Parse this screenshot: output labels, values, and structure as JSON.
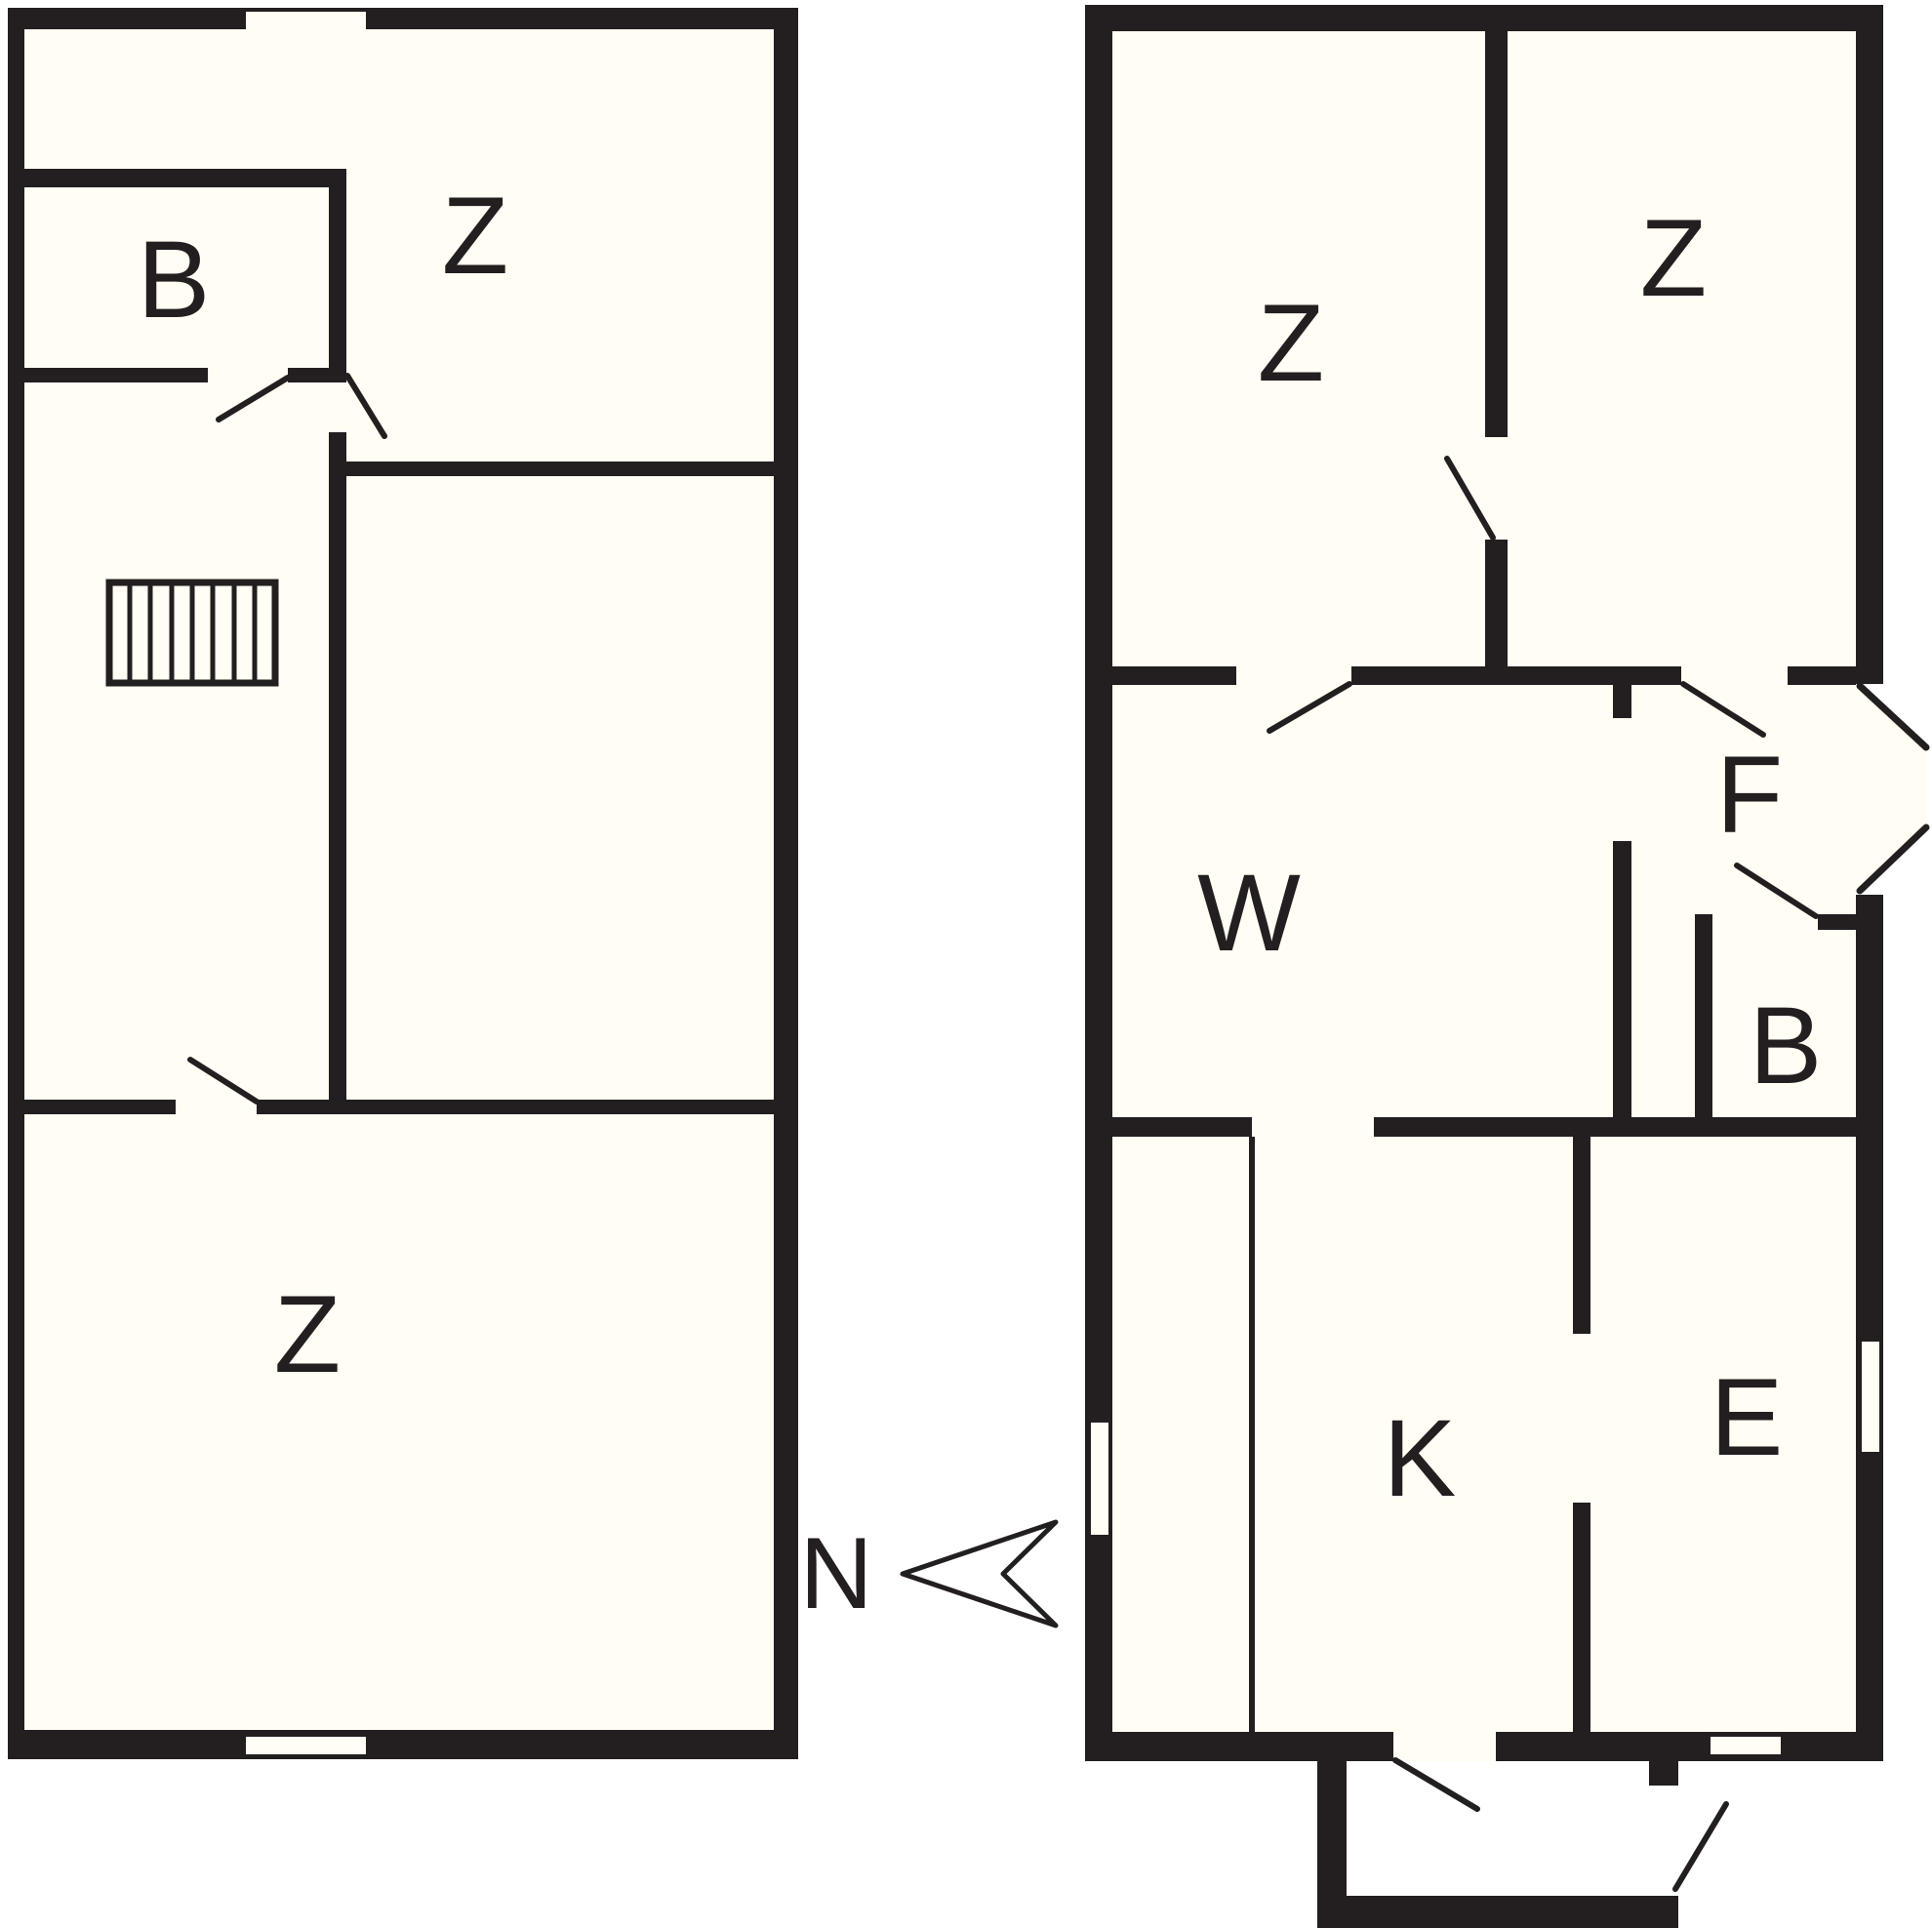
{
  "colors": {
    "wall": "#231f20",
    "floor": "#fffdf4",
    "background": "#ffffff"
  },
  "left_plan": {
    "rooms": [
      {
        "id": "room-b",
        "label": "B"
      },
      {
        "id": "room-z-top",
        "label": "Z"
      },
      {
        "id": "room-z-bottom",
        "label": "Z"
      }
    ]
  },
  "right_plan": {
    "rooms": [
      {
        "id": "room-z-left",
        "label": "Z"
      },
      {
        "id": "room-z-right",
        "label": "Z"
      },
      {
        "id": "room-f",
        "label": "F"
      },
      {
        "id": "room-w",
        "label": "W"
      },
      {
        "id": "room-b",
        "label": "B"
      },
      {
        "id": "room-k",
        "label": "K"
      },
      {
        "id": "room-e",
        "label": "E"
      }
    ]
  },
  "compass": {
    "label": "N"
  }
}
